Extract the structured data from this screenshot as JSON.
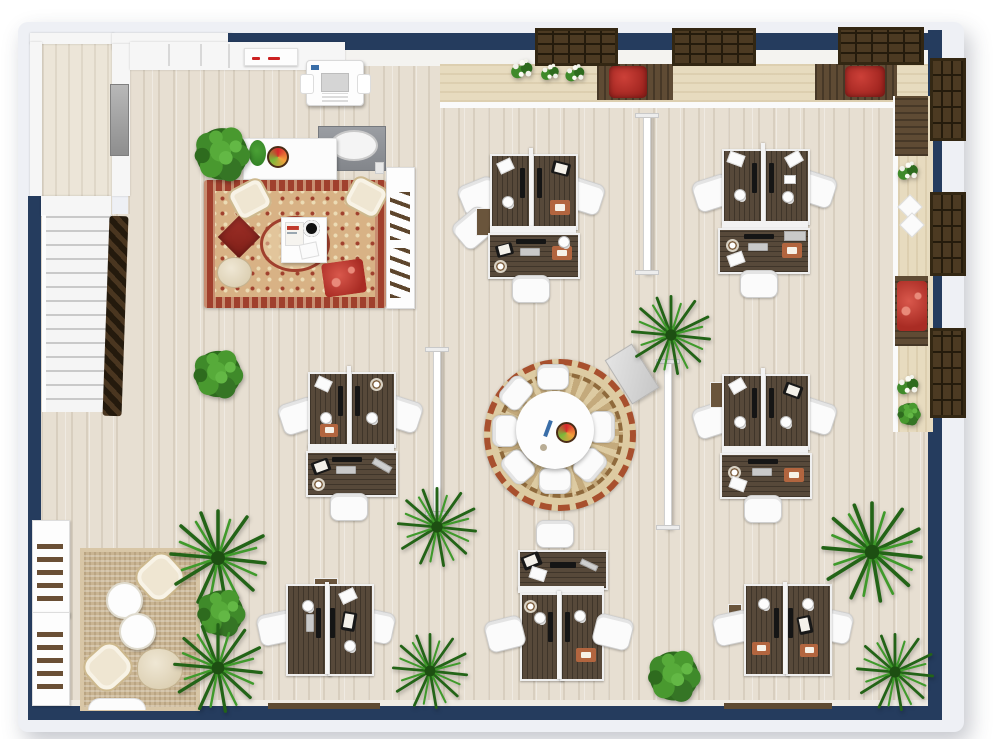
{
  "meta": {
    "title": "3D office floor plan - top-down view",
    "room_type": "open-plan office with lounge, meeting circle and workstation pods",
    "visible_text": "none"
  },
  "palette": {
    "wall_navy": "#253c5e",
    "wall_inner_white": "#f6f6f6",
    "floor_wood": "#e7dfd2",
    "hallway_wood": "#ece5d8",
    "desk_wood": "#57493a",
    "window_frame_brown": "#4c3a22",
    "bench_wood": "#5f4b34",
    "seat_cushion_red": "#b53129",
    "oriental_rug_red": "#a0402d",
    "oriental_rug_field": "#d8b285",
    "round_rug_border": "#a8502e",
    "jute_rug": "#c9b492",
    "plant_green_dark": "#2f7d23",
    "plant_green_light": "#4aa035",
    "desk_pad_orange": "#b2653f",
    "whiteboard_gray": "#d8d8d8"
  },
  "areas": {
    "lounge_top_left": {
      "items": [
        "kitchenette counter with oval sink",
        "potted plant on counter",
        "fruit bowl",
        "oriental red rug",
        "2 cream armchairs",
        "white coffee table with magazine and black round tray",
        "red floor cushion",
        "beige pouf",
        "red patterned pillow",
        "white shelving unit with brown items"
      ]
    },
    "workstations": {
      "pods_total": 7,
      "pods_four_desk_pinwheel": 5,
      "pods_two_desk": 2,
      "desk_surfaces": 19,
      "task_chairs": 21,
      "monitors": 16,
      "desk_accessories": [
        "keyboards",
        "white desk lamps",
        "black tablets",
        "papers",
        "coffee mugs",
        "orange desk pads",
        "silver laptop"
      ]
    },
    "meeting_circle_center": {
      "items": [
        "round white table",
        "7 white chairs",
        "round patterned rug with red zigzag border",
        "fruit bowl",
        "blue remote",
        "small ball"
      ]
    },
    "window_seating": {
      "top_benches_with_red_cushion": 2,
      "right_bench_with_red_pillow": 1,
      "corner_bench": 1,
      "windows_top_wall": 3,
      "windows_right_wall": 3,
      "ledge_flower_arrangements": 5,
      "ledge_papers": 2
    },
    "quiet_corner_bottom_left": {
      "items": [
        "jute area rug",
        "2 butterfly chairs",
        "2 round white side tables",
        "floor pouf",
        "2 white storage racks with brown items",
        "half-round wall table"
      ]
    },
    "circulation": {
      "items": [
        "staircase with dark wood banister",
        "upper hallway landing",
        "3 freestanding white divider screens",
        "tilted gray whiteboard",
        "copier printer",
        "white wall cabinet with red markers",
        "gray wall panel",
        "2 low wooden wall benches"
      ]
    },
    "plants": {
      "round_bushes": 4,
      "palms": 7,
      "flower_pots": 5
    }
  }
}
